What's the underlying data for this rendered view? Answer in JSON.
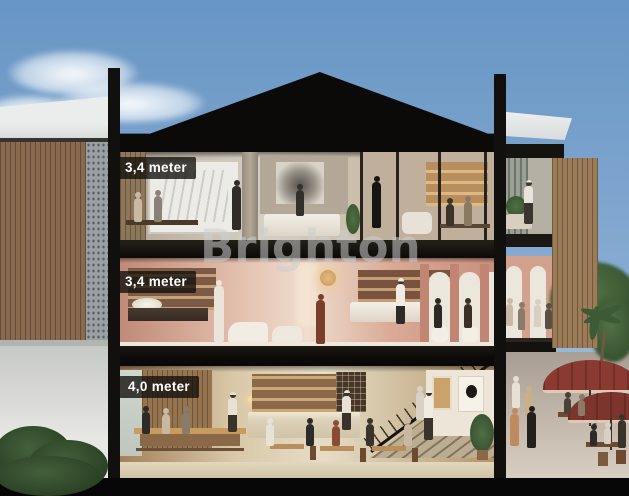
{
  "floors": [
    {
      "name": "upper-floor",
      "height_label": "3,4 meter"
    },
    {
      "name": "middle-floor",
      "height_label": "3,4 meter"
    },
    {
      "name": "ground-floor",
      "height_label": "4,0 meter"
    }
  ],
  "watermark": {
    "text": "Brighton"
  },
  "palette": {
    "sky_top": "#6795c4",
    "sky_mid": "#86abd2",
    "sky_bottom": "#b9cfe3",
    "roof_black": "#0b0a09",
    "frame_black": "#12100e",
    "slab_black": "#16130f",
    "label_bg": "rgba(18,15,12,0.78)",
    "label_text": "#ffffff",
    "watermark": "rgba(205,205,205,0.55)",
    "neighbor_white": "#ebecec",
    "wood_slat": "#8a6a4e",
    "screen_grey": "#9aa0a3",
    "office_wall": "#c2b39f",
    "whiteboard": "#edebe6",
    "salon_wall": "#cf9f8d",
    "salon_pilaster": "#c08573",
    "salon_arch": "#ece7dd",
    "resto_wood": "#a37a52",
    "street_ground": "#c3b8ab",
    "umbrella": "#8a3a30",
    "pillar_wood": "#9c7b57",
    "foliage": "#44603a",
    "foliage_dark": "#2c4226",
    "glow_gold": "#e2b97e"
  }
}
